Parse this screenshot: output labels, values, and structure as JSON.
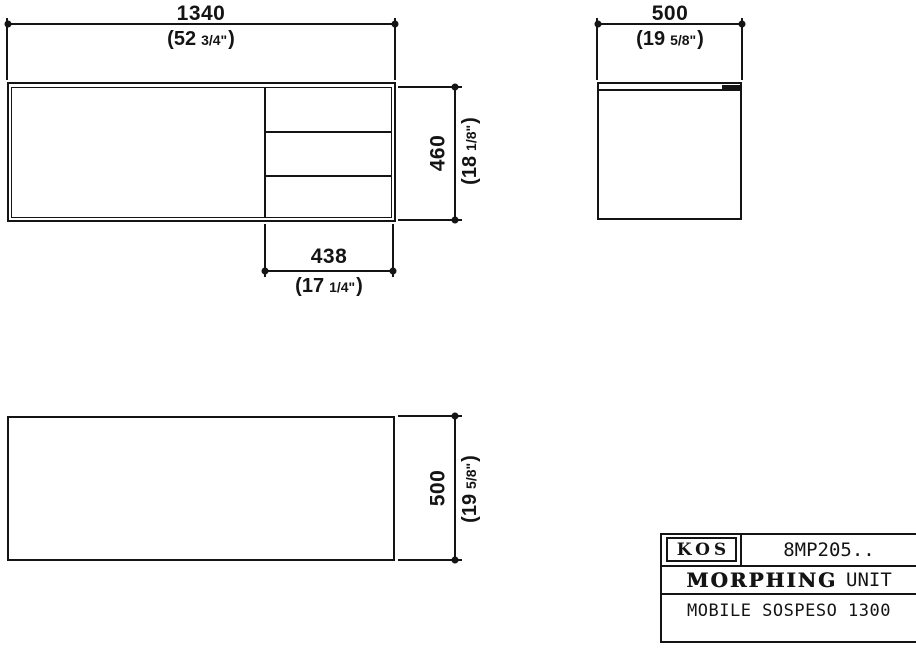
{
  "drawing": {
    "views": {
      "front_view": "front elevation with left door and three right drawers",
      "side_view": "side elevation",
      "top_view": "plan view"
    },
    "dimensions": {
      "front_width": {
        "mm": "1340",
        "inch_open": "(52",
        "inch_frac": "3/4\"",
        "inch_close": ")"
      },
      "front_height": {
        "mm": "460",
        "inch_open": "(18",
        "inch_frac": "1/8\"",
        "inch_close": ")"
      },
      "drawer_width": {
        "mm": "438",
        "inch_open": "(17",
        "inch_frac": "1/4\"",
        "inch_close": ")"
      },
      "side_depth": {
        "mm": "500",
        "inch_open": "(19",
        "inch_frac": "5/8\"",
        "inch_close": ")"
      },
      "top_depth": {
        "mm": "500",
        "inch_open": "(19",
        "inch_frac": "5/8\"",
        "inch_close": ")"
      }
    },
    "title_block": {
      "brand": "KOS",
      "model_code": "8MP205..",
      "series_logo": "MORPHING",
      "series_suffix": "UNIT",
      "description": "MOBILE SOSPESO 1300"
    },
    "colors": {
      "line": "#141414",
      "background": "#ffffff"
    }
  }
}
